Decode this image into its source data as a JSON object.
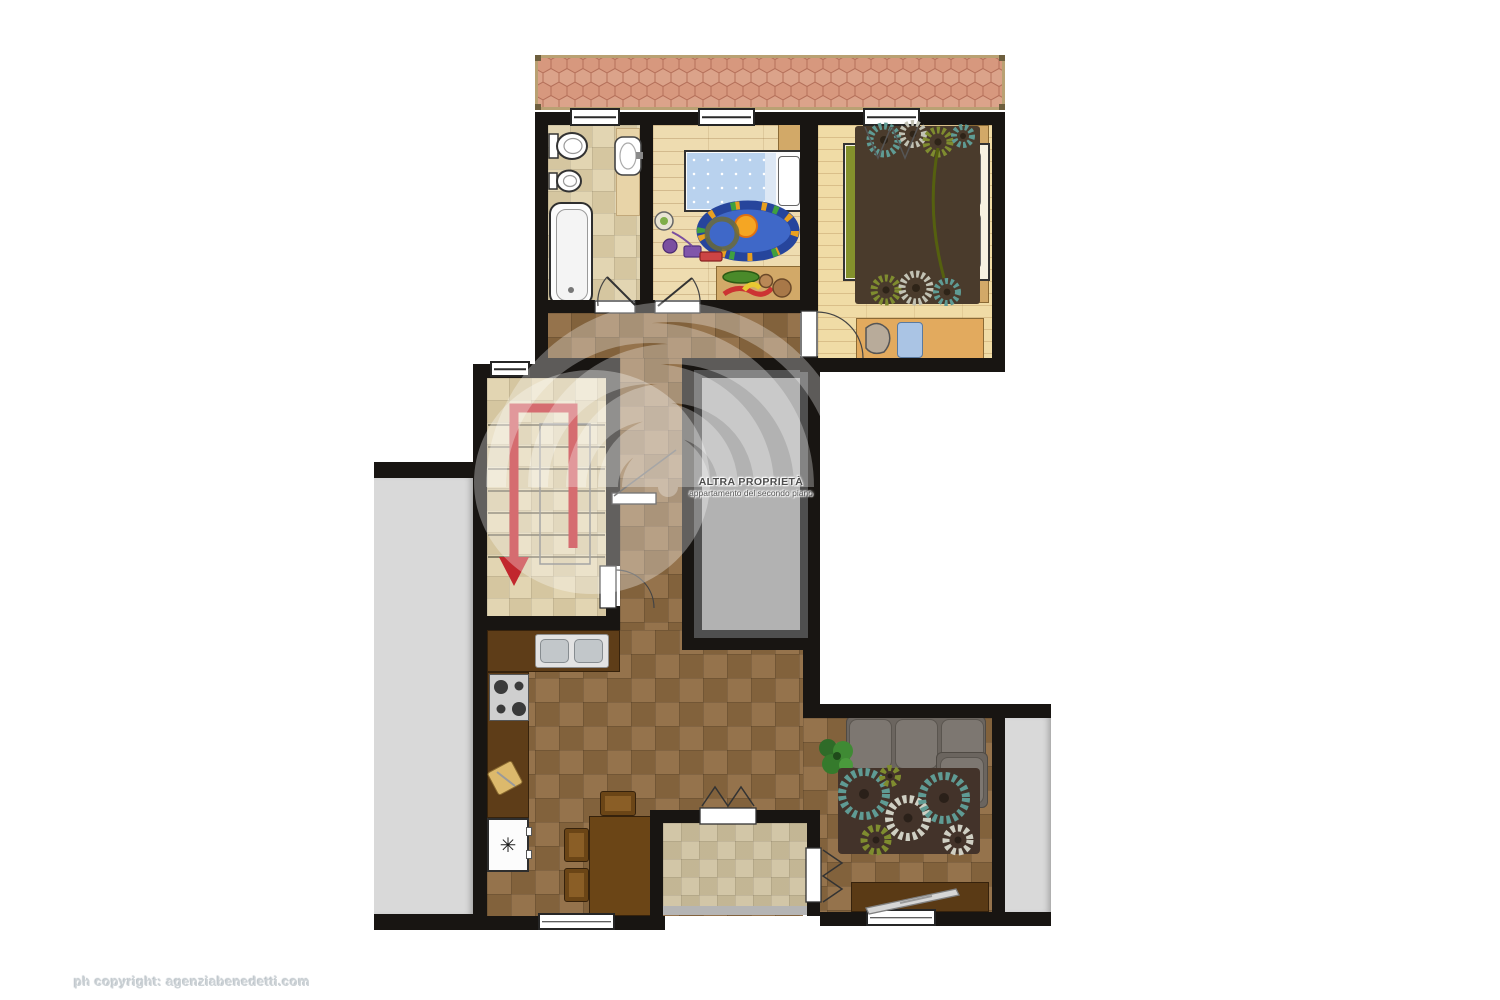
{
  "labels": {
    "other_property": {
      "line1": "ALTRA PROPRIETÀ",
      "line2": "appartamento del secondo piano"
    },
    "copyright": "ph copyright: agenziabenedetti.com"
  },
  "kitchen": {
    "fridge_symbol": "✳"
  },
  "palette": {
    "wall": "#181512",
    "roof_tile": "#d99e86",
    "roof_line": "#b5705a",
    "floor_tile_brown": "#8f6c42",
    "floor_tile_beige": "#e0d1ab",
    "wood_floor": "#eedcb0",
    "terrace_gray": "#d9d9d9",
    "other_property_fill": "#b2b2b2",
    "other_property_frame": "#4f4f4f",
    "stairs_arrow_red": "#c1272d",
    "kids_bed_blue": "#b9d2ee",
    "master_bed_green": "#84912c",
    "sofa_gray": "#6e6862",
    "rug_teal": "#5f9b94",
    "rug_olive": "#7f8c2f"
  }
}
